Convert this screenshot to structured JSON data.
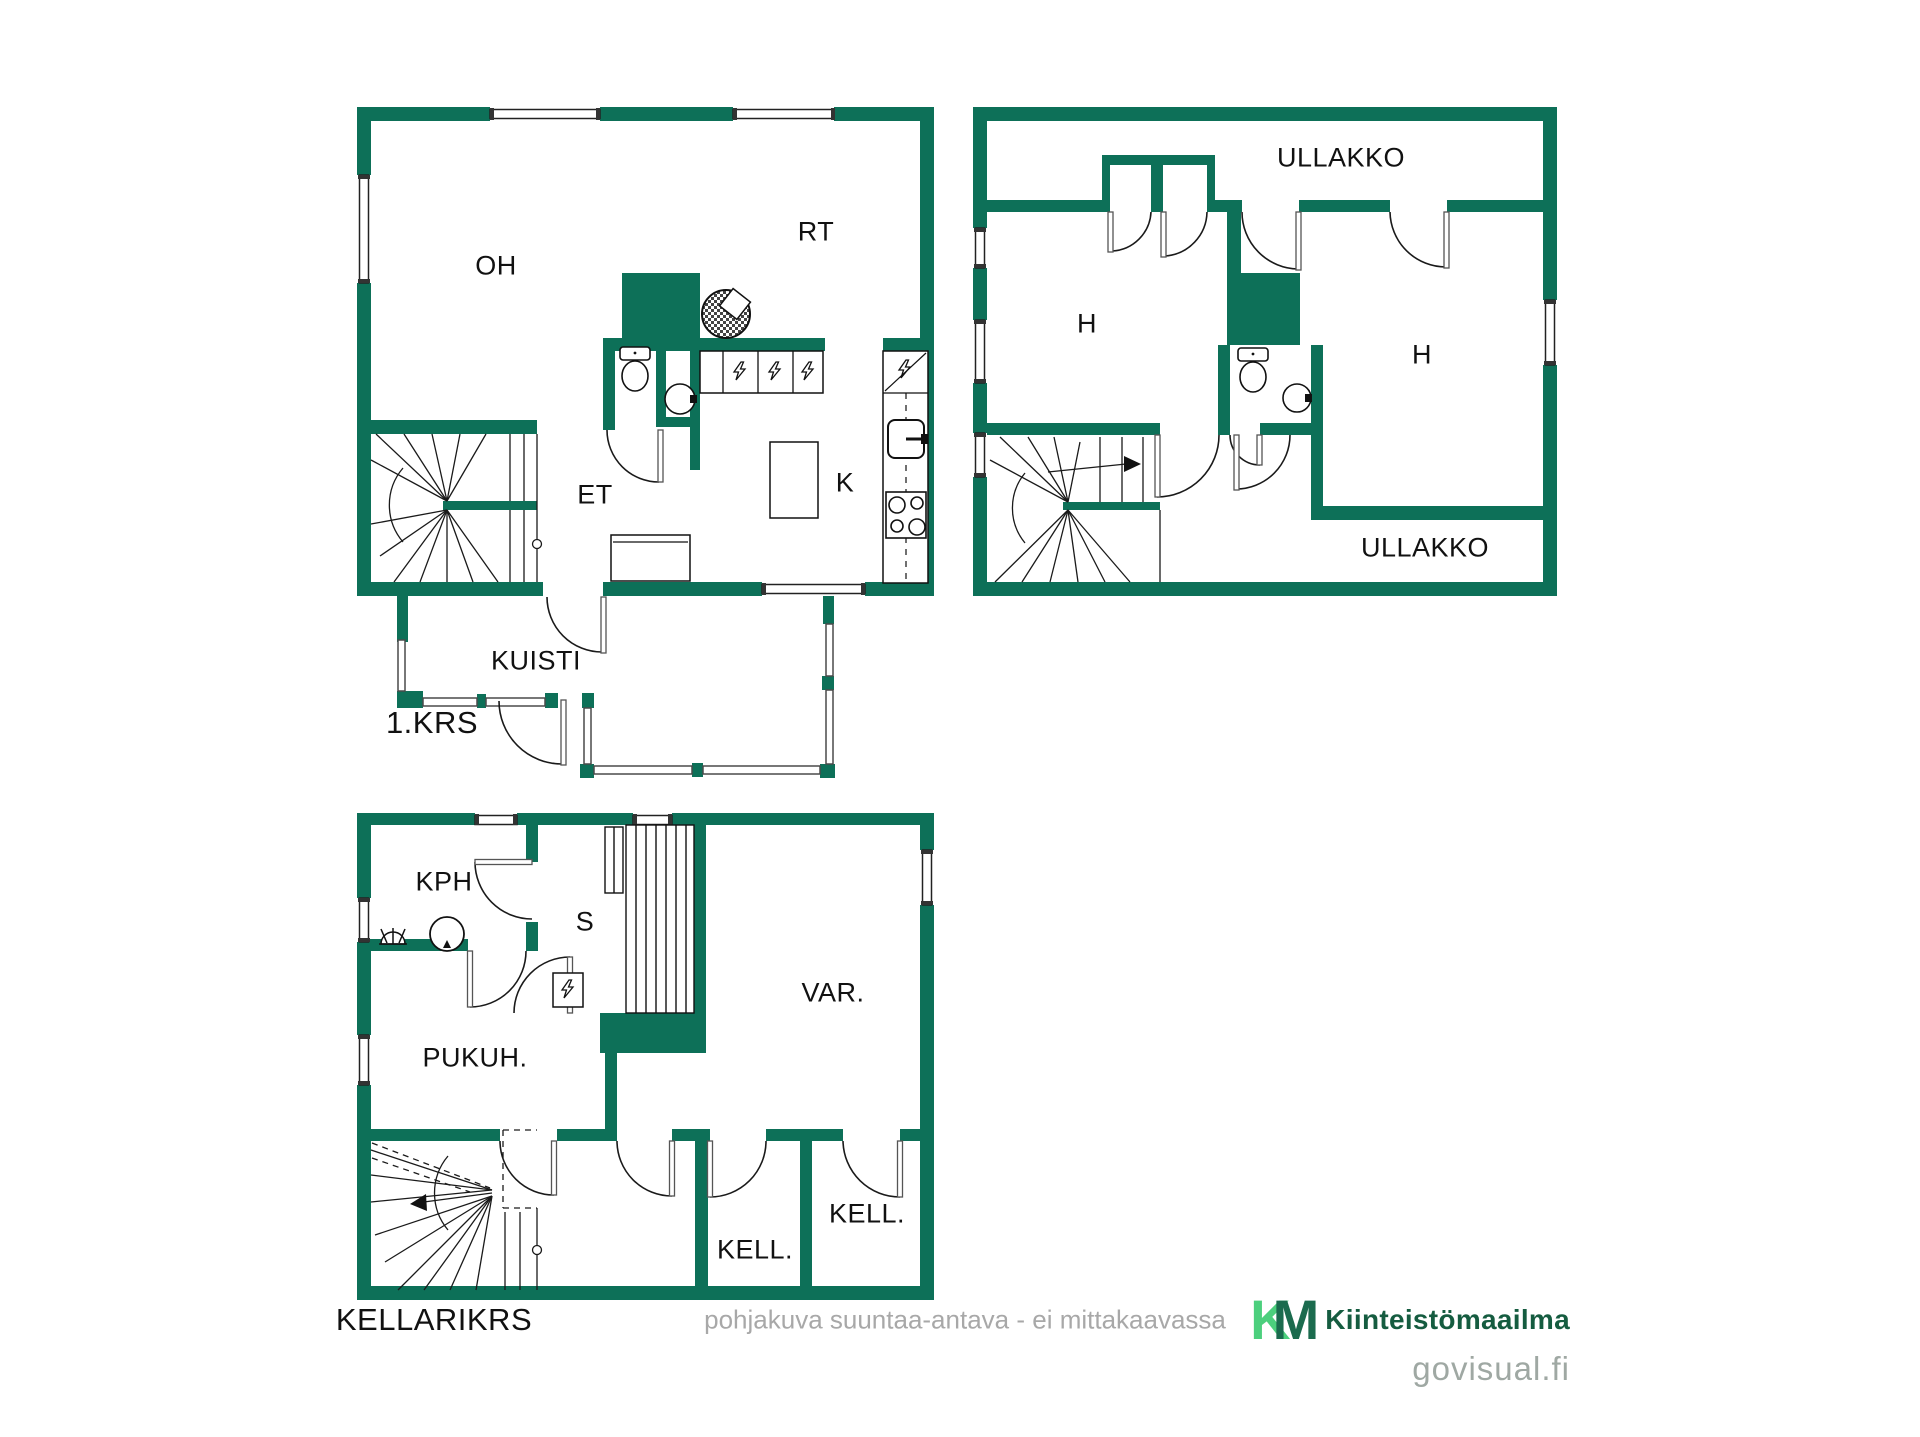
{
  "title": "pohjakuva / floor plan",
  "colors": {
    "wall_green": "#0d7058",
    "line_black": "#1a1a1a",
    "railing_gray": "#4a4a4a",
    "logo_light_green": "#4ccf7d",
    "logo_dark_green": "#1b6b4e",
    "logo_text_green": "#155c40",
    "muted_gray": "#a8a8a8",
    "watermark_gray": "#9fa8a3"
  },
  "floors": {
    "first": {
      "floor_label": "1.KRS",
      "rooms": {
        "oh": "OH",
        "rt": "RT",
        "et": "ET",
        "k": "K",
        "kuisti": "KUISTI"
      }
    },
    "attic": {
      "rooms": {
        "ullakko_top": "ULLAKKO",
        "h_left": "H",
        "h_right": "H",
        "ullakko_bottom": "ULLAKKO"
      }
    },
    "basement": {
      "floor_label": "KELLARIKRS",
      "rooms": {
        "kph": "KPH",
        "s": "S",
        "var": "VAR.",
        "pukuh": "PUKUH.",
        "kell_small": "KELL.",
        "kell_large": "KELL."
      }
    }
  },
  "icons": {
    "fireplace": "fireplace-icon",
    "toilet": "toilet-icon",
    "washbasin": "washbasin-icon",
    "appliance": "lightning-appliance-icon",
    "kitchen_sink": "kitchen-sink-icon",
    "stove": "stove-burners-icon",
    "shower": "shower-icon",
    "water_heater": "water-heater-icon",
    "sauna_stove": "sauna-stove-icon",
    "sauna_benches": "sauna-benches-icon"
  },
  "footer": {
    "disclaimer": "pohjakuva suuntaa-antava - ei mittakaavassa"
  },
  "branding": {
    "logo_mark_k": "K",
    "logo_mark_m": "M",
    "logo_text": "Kiinteistömaailma",
    "watermark": "govisual.fi"
  }
}
